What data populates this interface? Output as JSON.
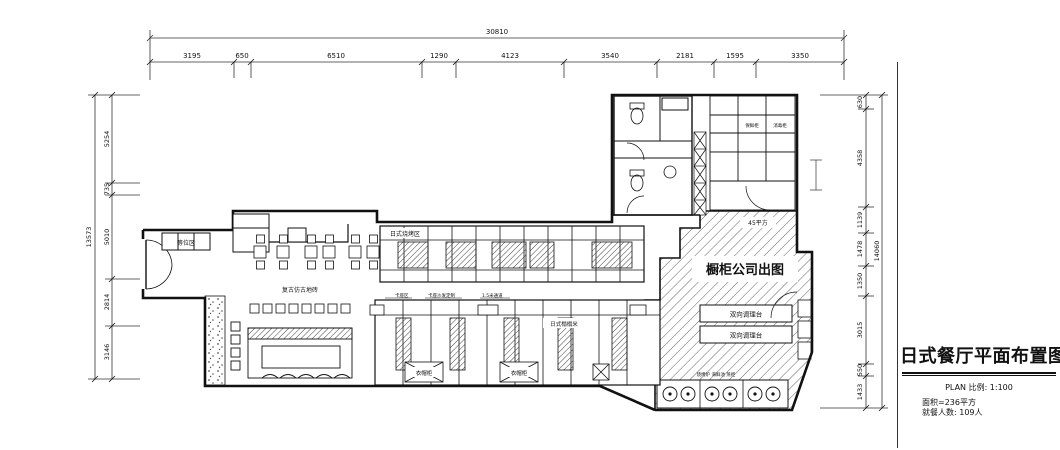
{
  "title_block": {
    "title": "日式餐厅平面布置图",
    "scale_line": "PLAN  比例: 1:100",
    "area_line": "面积=236平方",
    "diners_line": "就餐人数: 109人"
  },
  "dimensions": {
    "top": {
      "overall": "30810",
      "segments": [
        "3195",
        "650",
        "6510",
        "1290",
        "4123",
        "3540",
        "2181",
        "1595",
        "3350"
      ]
    },
    "left": {
      "overall": "13573",
      "segments": [
        "5254",
        "735",
        "5010",
        "2814",
        "3146"
      ]
    },
    "right": {
      "overall": "14060",
      "segments": [
        "630",
        "4358",
        "1139",
        "1478",
        "1350",
        "3015",
        "550",
        "1433"
      ]
    }
  },
  "labels": {
    "kitchen_area": "橱柜公司出图",
    "kitchen_size": "45平方",
    "prep_counter_1": "双向调理台",
    "prep_counter_2": "双向调理台",
    "waiting_area": "等位区",
    "floor_note": "复古仿古地砖",
    "grill_row": "日式烧烤区",
    "tatami": "日式榻榻米",
    "wardrobe_1": "衣帽柜",
    "wardrobe_2": "衣帽柜",
    "fridge": "保鲜柜",
    "disinfect": "消毒柜",
    "note_1": "卡座区",
    "note_2": "卡座沙发定制",
    "note_3": "1.5米通道",
    "stove_note": "烧烤炉 海鲜池 蒸柜"
  }
}
